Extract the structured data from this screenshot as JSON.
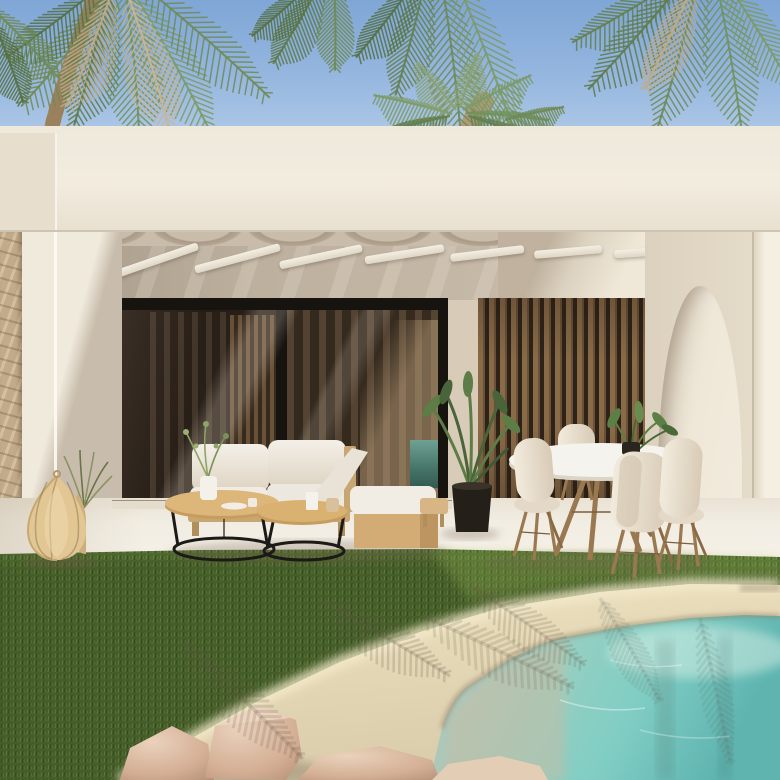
{
  "scene": {
    "description": "3D architectural render of a modern white villa patio with pergola, sliding glass doors, timber slat screen, arched doorway, outdoor lounge furniture, dining set, lawn and a sandy-edged turquoise pool framed by palm trees",
    "objects": [
      "sky",
      "palm-canopy",
      "palm-trunk",
      "palm-crown",
      "roof-fascia",
      "pergola-beams",
      "canopy-scallops",
      "stone-clad-wall",
      "sliding-glass-door",
      "timber-slat-screen",
      "arched-doorway",
      "corner-pillar",
      "patio-floor",
      "outdoor-sofa",
      "chaise-daybed",
      "nesting-coffee-tables",
      "decor-vase",
      "rattan-floor-lanterns",
      "ornamental-grass",
      "potted-plant",
      "wood-stool",
      "round-dining-table",
      "shell-chairs",
      "table-plant",
      "grass-lawn",
      "sand-beach-edge",
      "palm-shadows",
      "rocks",
      "pool-water"
    ]
  },
  "palette": {
    "sky_top": "#7FA6D6",
    "sky_horizon": "#D9E5F2",
    "fascia": "#F1EBDE",
    "wall_bright": "#F2EBDD",
    "wall_shade": "#B7AB9B",
    "ceiling_shade": "#C9BCAA",
    "beam_white": "#F2EDE1",
    "glass_dark": "#2C2218",
    "frame_black": "#17130F",
    "wood_slat": "#8A6B47",
    "wood_light": "#D2AC74",
    "cushion_white": "#F0ECE3",
    "shell_chair": "#EDE4D4",
    "grass_dark": "#3C5423",
    "grass_mid": "#4F6A2F",
    "grass_light": "#6B8A46",
    "sand": "#E9DEBE",
    "sand_shadow": "#B9A98E",
    "water_teal": "#7FCDC4",
    "water_aqua": "#93CFC2",
    "water_grey": "#C2C4B2",
    "rock_pink": "#D9B49B",
    "stone_tan": "#C2AB89",
    "rattan": "#D9BC8C"
  },
  "palms": {
    "trunks": [
      {
        "d": "M96,-6 C82,30 66,72 52,126",
        "w": 15,
        "c": "#A68D6C"
      },
      {
        "d": "M96,-6 C82,30 66,72 52,126",
        "w": 15,
        "c": "#8F7752",
        "dash": "3 8",
        "o": 0.55
      },
      {
        "d": "M470,128 C474,116 478,108 484,102",
        "w": 20,
        "c": "#B09A78"
      }
    ],
    "fronds": [
      {
        "x": 118,
        "y": -12,
        "a": 118,
        "len": 150,
        "bend": 30,
        "leaf": 34,
        "c": "#6F8A57",
        "d": 0.5
      },
      {
        "x": 108,
        "y": -10,
        "a": 95,
        "len": 138,
        "bend": 22,
        "leaf": 32,
        "c": "#5E7A4A",
        "d": 0.55
      },
      {
        "x": 125,
        "y": -12,
        "a": 74,
        "len": 150,
        "bend": 28,
        "leaf": 33,
        "c": "#71925D",
        "d": 0.5
      },
      {
        "x": 132,
        "y": -10,
        "a": 52,
        "len": 162,
        "bend": 26,
        "leaf": 33,
        "c": "#7C9A66",
        "d": 0.45
      },
      {
        "x": 142,
        "y": -15,
        "a": 32,
        "len": 168,
        "bend": 28,
        "leaf": 30,
        "c": "#6F8A57",
        "d": 0.4
      },
      {
        "x": 112,
        "y": -8,
        "a": 104,
        "len": 122,
        "bend": 16,
        "leaf": 29,
        "c": "#C2AB87",
        "d": 0.6
      },
      {
        "x": 128,
        "y": -5,
        "a": 64,
        "len": 140,
        "bend": 22,
        "leaf": 30,
        "c": "#CBB593",
        "d": 0.55
      },
      {
        "x": 96,
        "y": -10,
        "a": 136,
        "len": 112,
        "bend": 14,
        "leaf": 26,
        "c": "#557044",
        "d": 0.5
      },
      {
        "x": -8,
        "y": 8,
        "a": 38,
        "len": 95,
        "bend": 14,
        "leaf": 24,
        "c": "#6F8A57",
        "d": 0.45
      },
      {
        "x": -6,
        "y": 22,
        "a": 62,
        "len": 85,
        "bend": 12,
        "leaf": 22,
        "c": "#557044",
        "d": 0.5
      },
      {
        "x": 322,
        "y": -20,
        "a": 112,
        "len": 96,
        "bend": 14,
        "leaf": 24,
        "c": "#5E7A4A",
        "d": 0.55
      },
      {
        "x": 334,
        "y": -22,
        "a": 82,
        "len": 92,
        "bend": 12,
        "leaf": 22,
        "c": "#6F8A57",
        "d": 0.5
      },
      {
        "x": 314,
        "y": -18,
        "a": 132,
        "len": 82,
        "bend": 10,
        "leaf": 20,
        "c": "#557044",
        "d": 0.5
      },
      {
        "x": 426,
        "y": -24,
        "a": 96,
        "len": 122,
        "bend": 18,
        "leaf": 26,
        "c": "#647F4E",
        "d": 0.55
      },
      {
        "x": 440,
        "y": -28,
        "a": 74,
        "len": 168,
        "bend": 26,
        "leaf": 30,
        "c": "#6F8A57",
        "d": 0.5
      },
      {
        "x": 452,
        "y": -30,
        "a": 60,
        "len": 186,
        "bend": 30,
        "leaf": 30,
        "c": "#7C9A66",
        "d": 0.45
      },
      {
        "x": 418,
        "y": -22,
        "a": 120,
        "len": 100,
        "bend": 14,
        "leaf": 24,
        "c": "#557044",
        "d": 0.55
      },
      {
        "x": 688,
        "y": -25,
        "a": 122,
        "len": 150,
        "bend": 24,
        "leaf": 30,
        "c": "#5E7A4A",
        "d": 0.5
      },
      {
        "x": 700,
        "y": -28,
        "a": 96,
        "len": 160,
        "bend": 26,
        "leaf": 31,
        "c": "#6F8A57",
        "d": 0.5
      },
      {
        "x": 714,
        "y": -30,
        "a": 72,
        "len": 165,
        "bend": 24,
        "leaf": 31,
        "c": "#71925D",
        "d": 0.45
      },
      {
        "x": 678,
        "y": -20,
        "a": 142,
        "len": 122,
        "bend": 16,
        "leaf": 26,
        "c": "#647F4E",
        "d": 0.5
      },
      {
        "x": 722,
        "y": -24,
        "a": 50,
        "len": 132,
        "bend": 18,
        "leaf": 26,
        "c": "#7C9A66",
        "d": 0.4
      },
      {
        "x": 694,
        "y": -18,
        "a": 108,
        "len": 118,
        "bend": 14,
        "leaf": 24,
        "c": "#C2AB87",
        "d": 0.6
      },
      {
        "x": 452,
        "y": 114,
        "a": -158,
        "len": 80,
        "bend": -12,
        "leaf": 20,
        "c": "#7C9A66",
        "d": 0.85
      },
      {
        "x": 456,
        "y": 110,
        "a": -122,
        "len": 62,
        "bend": -8,
        "leaf": 18,
        "c": "#8AA272",
        "d": 0.9
      },
      {
        "x": 460,
        "y": 108,
        "a": -78,
        "len": 58,
        "bend": 6,
        "leaf": 18,
        "c": "#8AA272",
        "d": 0.9
      },
      {
        "x": 463,
        "y": 110,
        "a": -36,
        "len": 76,
        "bend": 12,
        "leaf": 19,
        "c": "#7C9A66",
        "d": 0.85
      },
      {
        "x": 466,
        "y": 113,
        "a": -6,
        "len": 82,
        "bend": 16,
        "leaf": 20,
        "c": "#71925D",
        "d": 0.8
      },
      {
        "x": 450,
        "y": 116,
        "a": 176,
        "len": 74,
        "bend": -14,
        "leaf": 19,
        "c": "#647F4E",
        "d": 0.8
      },
      {
        "x": 468,
        "y": 116,
        "a": 10,
        "len": 78,
        "bend": 14,
        "leaf": 19,
        "c": "#647F4E",
        "d": 0.75
      },
      {
        "x": 505,
        "y": 120,
        "a": -20,
        "len": 60,
        "bend": 8,
        "leaf": 15,
        "c": "#6F8A57",
        "d": 0.8
      }
    ],
    "shadow_fronds": [
      {
        "x": 320,
        "y": 600,
        "a": 25,
        "len": 150,
        "bend": 14,
        "leaf": 26,
        "c": "rgba(100,88,70,0.25)",
        "d": 0.3,
        "w": 2.5
      },
      {
        "x": 470,
        "y": 585,
        "a": 30,
        "len": 140,
        "bend": 12,
        "leaf": 24,
        "c": "rgba(100,88,70,0.22)",
        "d": 0.3,
        "w": 2.5
      },
      {
        "x": 420,
        "y": 615,
        "a": 20,
        "len": 170,
        "bend": 16,
        "leaf": 26,
        "c": "rgba(100,88,70,0.2)",
        "d": 0.3,
        "w": 3
      },
      {
        "x": 180,
        "y": 640,
        "a": 38,
        "len": 170,
        "bend": 18,
        "leaf": 26,
        "c": "rgba(100,88,70,0.22)",
        "d": 0.35,
        "w": 3
      },
      {
        "x": 600,
        "y": 598,
        "a": 55,
        "len": 120,
        "bend": 10,
        "leaf": 20,
        "c": "rgba(95,105,95,0.16)",
        "d": 0.4,
        "w": 3
      },
      {
        "x": 700,
        "y": 618,
        "a": 75,
        "len": 150,
        "bend": 8,
        "leaf": 18,
        "c": "rgba(90,110,100,0.16)",
        "d": 0.4,
        "w": 3
      }
    ]
  }
}
